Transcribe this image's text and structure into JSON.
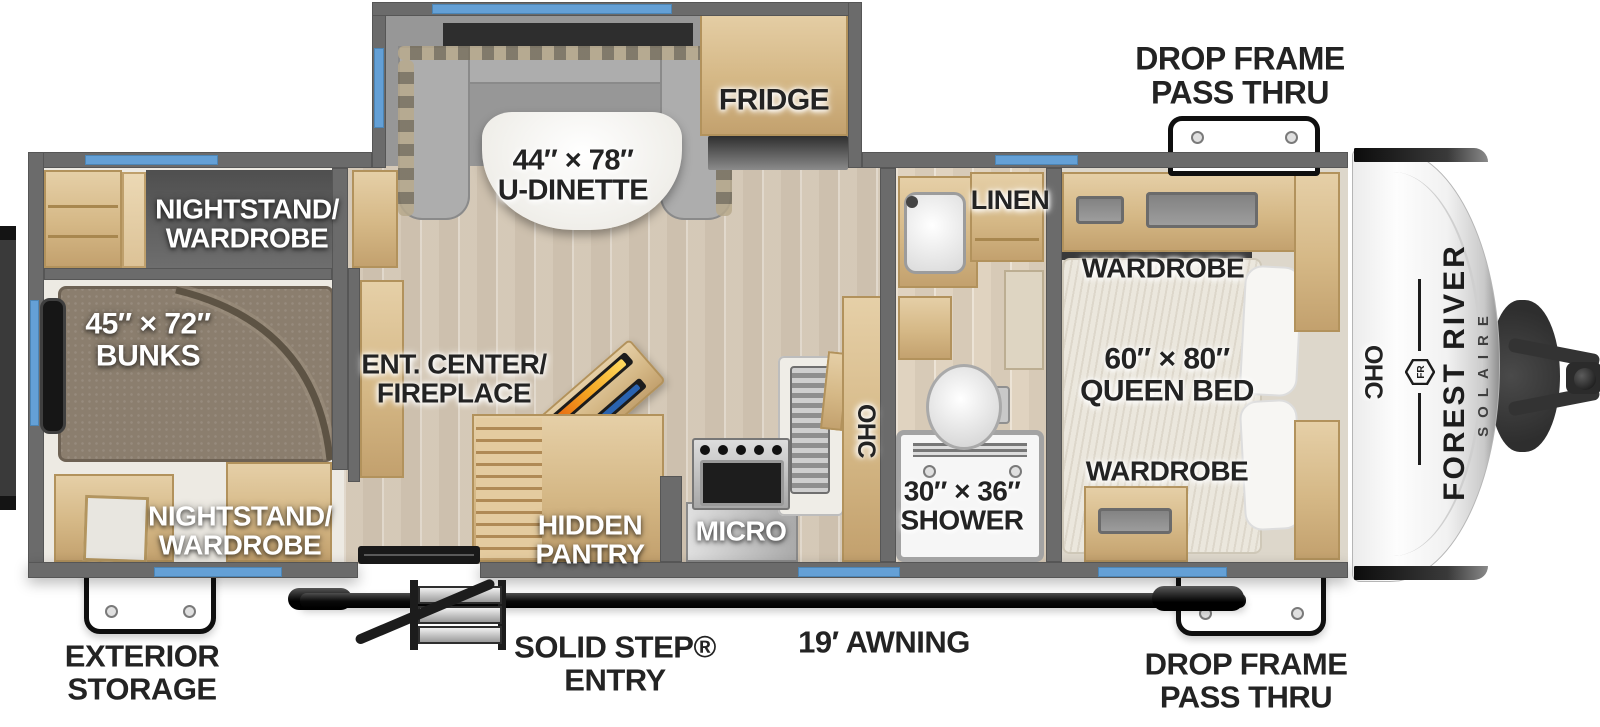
{
  "title": "Forest River Solaire travel trailer floor plan",
  "colors": {
    "window_blue": "#64a0d6",
    "wall_gray": "#6b6b6b",
    "floor_wood": "#dcd1c0",
    "cabinet_wood": "#d5b886",
    "label_dark": "#232323",
    "label_light": "#ffffff",
    "awning_black": "#111111",
    "fireplace_orange": "#e8680f",
    "fireplace_blue": "#2a63b0"
  },
  "exterior": {
    "pass_thru_top": [
      "DROP FRAME",
      "PASS THRU"
    ],
    "pass_thru_bottom": [
      "DROP FRAME",
      "PASS THRU"
    ],
    "exterior_storage": [
      "EXTERIOR",
      "STORAGE"
    ],
    "entry": [
      "SOLID STEP®",
      "ENTRY"
    ],
    "awning": "19′ AWNING"
  },
  "brand": {
    "make": "FOREST RIVER",
    "model": "SOLAIRE",
    "monogram": "FR"
  },
  "rooms": {
    "slideout": {
      "size": "44″ × 78″",
      "name": "U-DINETTE",
      "fridge": "FRIDGE"
    },
    "bunkroom": {
      "nightstand_top": [
        "NIGHTSTAND/",
        "WARDROBE"
      ],
      "bunks_size": "45″ × 72″",
      "bunks_name": "BUNKS",
      "nightstand_bottom": [
        "NIGHTSTAND/",
        "WARDROBE"
      ]
    },
    "living": {
      "ent_center": [
        "ENT. CENTER/",
        "FIREPLACE"
      ]
    },
    "kitchen": {
      "pantry": [
        "HIDDEN",
        "PANTRY"
      ],
      "micro": "MICRO",
      "ohc": "OHC"
    },
    "bathroom": {
      "linen": "LINEN",
      "shower_size": "30″ × 36″",
      "shower_name": "SHOWER"
    },
    "bedroom": {
      "wardrobe_top": "WARDROBE",
      "bed_size": "60″ × 80″",
      "bed_name": "QUEEN BED",
      "wardrobe_bottom": "WARDROBE",
      "ohc": "OHC"
    }
  }
}
